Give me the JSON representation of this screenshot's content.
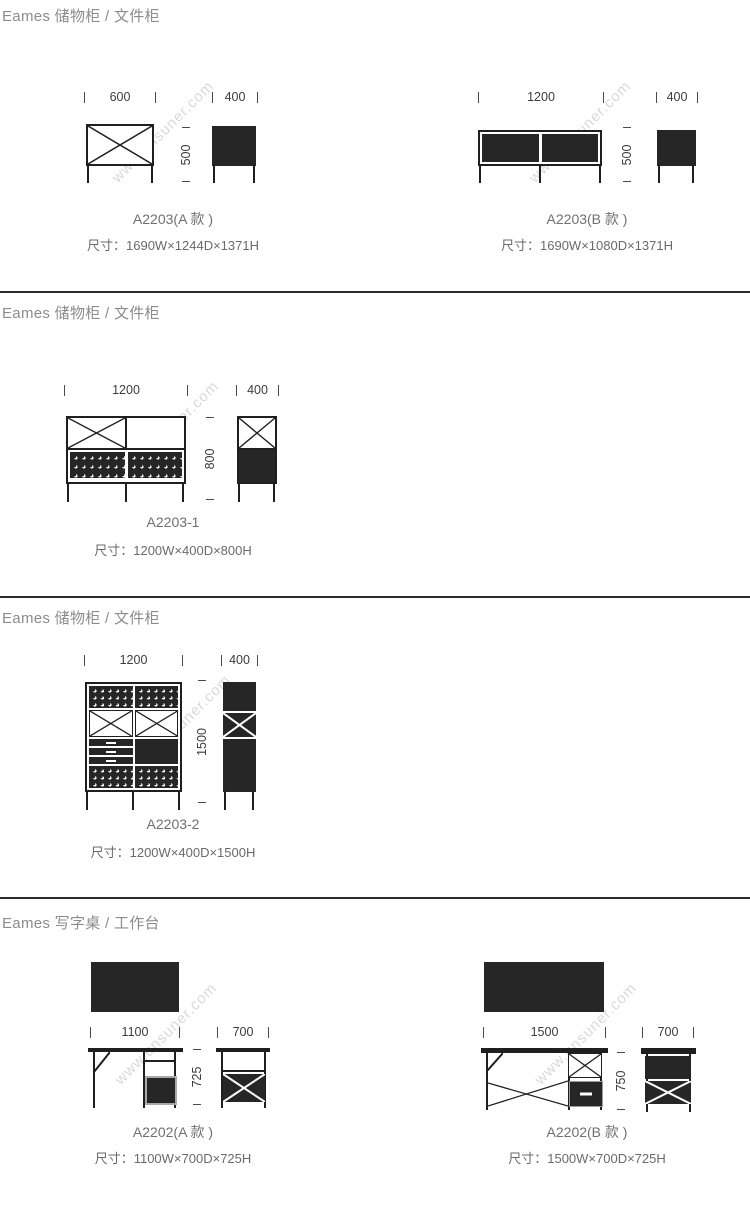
{
  "watermark": {
    "text": "www.unsuner.com"
  },
  "colors": {
    "ink": "#1f1f1f",
    "fill": "#262626",
    "caption_gray": "#707070",
    "header_gray": "#8c8c8c",
    "watermark_gray": "#d9d9d9"
  },
  "sections": [
    {
      "header": "Eames 储物柜 / 文件柜",
      "products": [
        {
          "name": "A2203(A 款 )",
          "size": "尺寸：1690W×1244D×1371H",
          "dims": {
            "front_width": "600",
            "side_width": "400",
            "height": "500"
          }
        },
        {
          "name": "A2203(B 款 )",
          "size": "尺寸：1690W×1080D×1371H",
          "dims": {
            "front_width": "1200",
            "side_width": "400",
            "height": "500"
          }
        }
      ]
    },
    {
      "header": "Eames 储物柜 / 文件柜",
      "products": [
        {
          "name": "A2203-1",
          "size": "尺寸：1200W×400D×800H",
          "dims": {
            "front_width": "1200",
            "side_width": "400",
            "height": "800"
          }
        }
      ]
    },
    {
      "header": "Eames 储物柜 / 文件柜",
      "products": [
        {
          "name": "A2203-2",
          "size": "尺寸：1200W×400D×1500H",
          "dims": {
            "front_width": "1200",
            "side_width": "400",
            "height": "1500"
          }
        }
      ]
    },
    {
      "header": "Eames 写字桌 / 工作台",
      "products": [
        {
          "name": "A2202(A 款 )",
          "size": "尺寸：1100W×700D×725H",
          "dims": {
            "front_width": "1100",
            "side_width": "700",
            "height": "725"
          }
        },
        {
          "name": "A2202(B 款 )",
          "size": "尺寸：1500W×700D×725H",
          "dims": {
            "front_width": "1500",
            "side_width": "700",
            "height": "750"
          }
        }
      ]
    }
  ]
}
